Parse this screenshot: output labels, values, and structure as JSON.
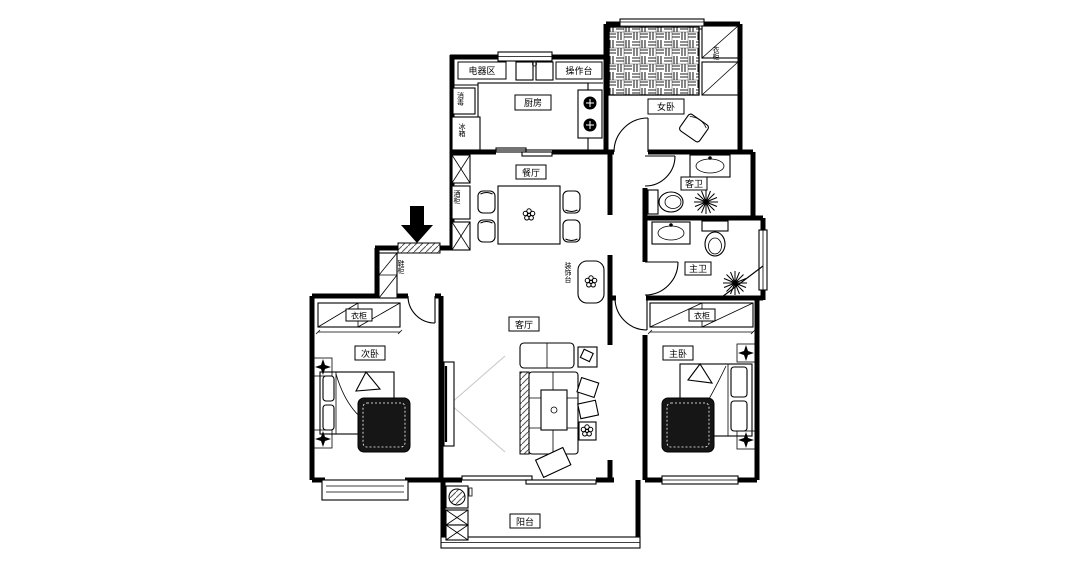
{
  "plan": {
    "rooms": {
      "kitchen": "厨房",
      "dining": "餐厅",
      "living": "客厅",
      "balcony": "阳台",
      "bedroom_secondary": "次卧",
      "bedroom_master": "主卧",
      "bedroom_small": "女卧",
      "bath_guest": "客卫",
      "bath_master": "主卫"
    },
    "fixtures": {
      "appliance_area": "电器区",
      "counter": "操作台",
      "disinfect": "消毒",
      "fridge": "冰箱",
      "wine_cabinet": "酒柜",
      "shoe_cabinet": "鞋柜",
      "wardrobe": "衣柜",
      "deco_stand": "装饰台"
    },
    "colors": {
      "line": "#000000",
      "background": "#ffffff",
      "rug": "#161616"
    }
  }
}
